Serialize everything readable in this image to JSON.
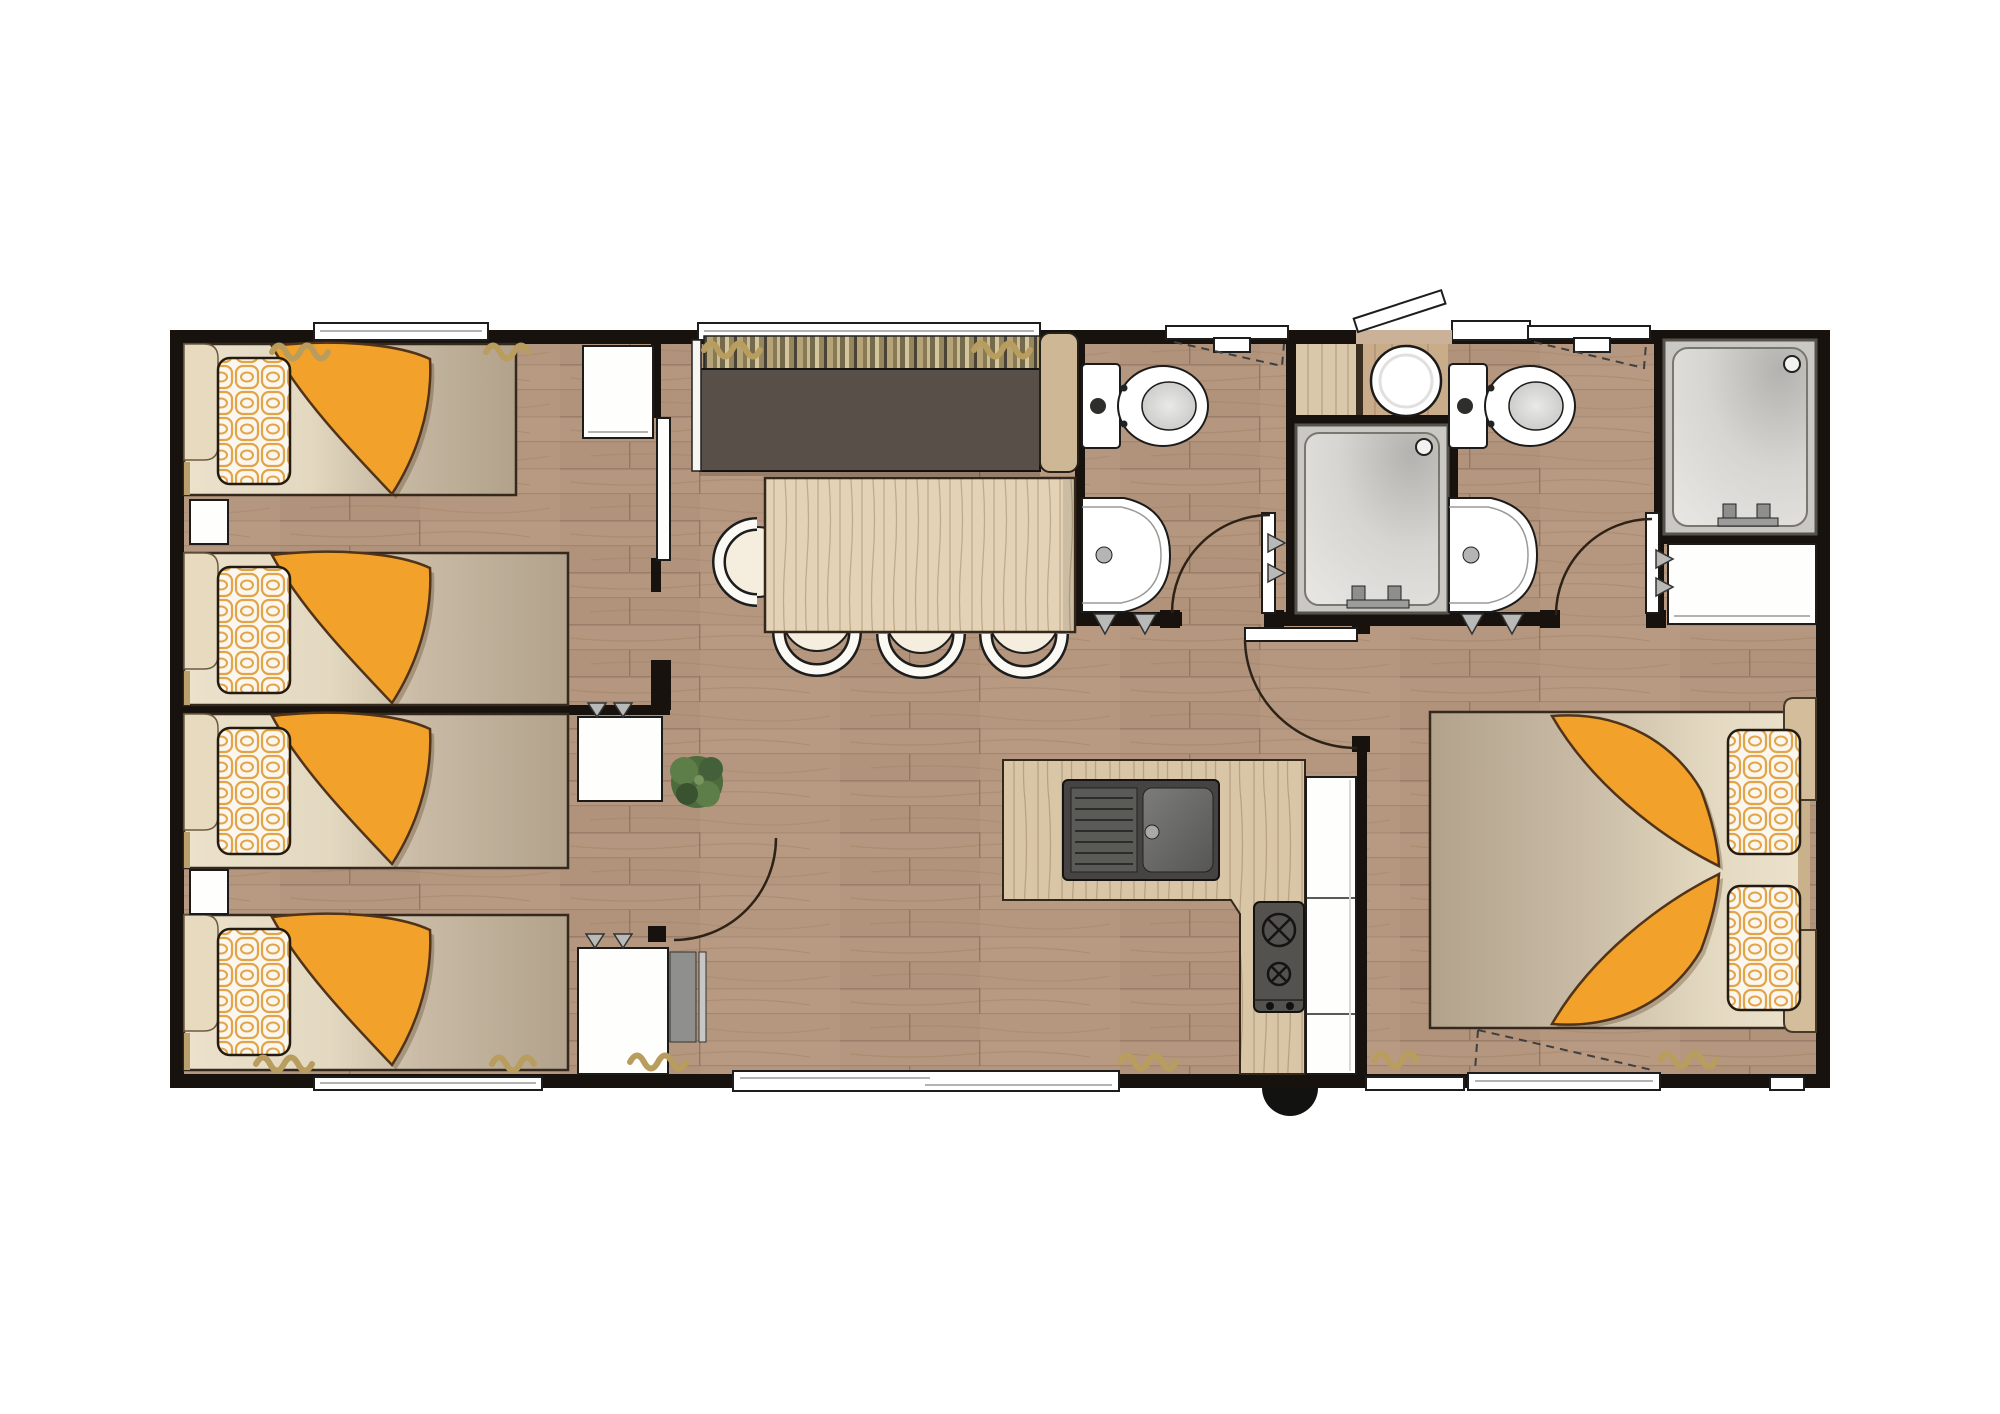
{
  "scene": {
    "type": "floor-plan",
    "subject": "mobile-home holiday lodge, top-down architectural plan",
    "orientation": "landscape",
    "visible_text": "none"
  },
  "colors": {
    "accent": "#f2a12b",
    "wall": "#17120d",
    "floor": "#b5977f",
    "floor_seam": "#9a7e69",
    "mattress_cream": "#ece2cc",
    "mattress_taupe": "#b2a28c",
    "pillow_lattice": "#e2a449",
    "headboard": "#c9b28b",
    "sofa_seat": "#574f48",
    "cushion_stripe_olive": "#95865e",
    "cushion_stripe_cream": "#d3c69c",
    "table_wood": "#e3d2b5",
    "counter_wood": "#d9c6a7",
    "cabinet_white": "#ffffff",
    "appliance_steel": "#54524e",
    "fixture_white": "#ffffff",
    "shower_tray": "#d6d5d1",
    "curtain": "#b89d5e",
    "plant": "#4e6b3c",
    "door_arc": "#2e2217",
    "dash": "#3f3f3f",
    "step": "#121210"
  },
  "inventory": {
    "rooms": [
      {
        "name": "twin-bedroom-front",
        "position": "top-left",
        "items": [
          "single bed x2",
          "orange blanket x2",
          "lattice pillow x2",
          "headboard shelf x2",
          "nightstand",
          "wardrobe",
          "sliding door",
          "window with curtains"
        ]
      },
      {
        "name": "twin-bedroom-rear",
        "position": "bottom-left",
        "items": [
          "single bed x2",
          "orange blanket x2",
          "lattice pillow x2",
          "headboard shelf x2",
          "nightstand",
          "wardrobe x2 with hanger hooks",
          "hinged door",
          "heater panel",
          "window with curtains"
        ]
      },
      {
        "name": "living-dining",
        "position": "top-center",
        "items": [
          "sofa with striped back cushions",
          "dining table",
          "chair x4",
          "panoramic window with curtains"
        ]
      },
      {
        "name": "kitchen",
        "position": "bottom-center",
        "items": [
          "L-shaped worktop",
          "double sink with drainer",
          "2-burner hob",
          "tall cabinet column",
          "patio sliding door",
          "outside entry step"
        ]
      },
      {
        "name": "shower-room-front",
        "position": "top-center-right",
        "items": [
          "toilet",
          "hand basin",
          "coat hooks",
          "openable window",
          "hinged door"
        ]
      },
      {
        "name": "central-shower-module",
        "position": "top-right-of-center",
        "items": [
          "shower cubicle",
          "round basin on worktop",
          "storage cabinet",
          "entrance door shown open outward",
          "sidelight window"
        ]
      },
      {
        "name": "shower-room-rear",
        "position": "top-right",
        "items": [
          "toilet",
          "hand basin",
          "openable window",
          "hinged door"
        ]
      },
      {
        "name": "master-suite",
        "position": "right",
        "items": [
          "double bed",
          "orange blanket x2",
          "lattice pillow x2",
          "nightstand x2",
          "large shower cubicle",
          "wardrobe with hooks",
          "hinged door",
          "french window with curtains",
          "corner window"
        ]
      }
    ],
    "totals": {
      "single_beds": 4,
      "double_beds": 1,
      "toilets": 2,
      "showers": 2,
      "hand_basins": 2,
      "round_basins": 1,
      "dining_chairs": 4,
      "hinged_doors": 4,
      "sliding_doors": 2,
      "windows": 9,
      "wardrobes": 5
    }
  }
}
